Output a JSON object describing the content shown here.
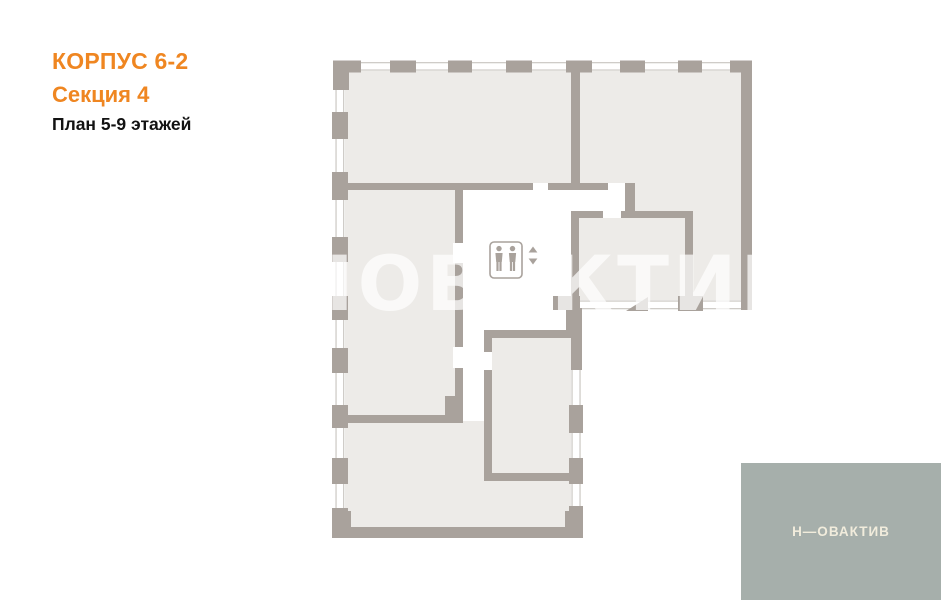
{
  "header": {
    "corpus": "КОРПУС 6-2",
    "section": "Секция 4",
    "floors_plan": "План 5-9 этажей"
  },
  "floor_plan": {
    "watermark": "НОВАКТИВ",
    "elevator_icon": "elevator-two-persons",
    "elevator_arrows": [
      "up",
      "down"
    ]
  },
  "branding": {
    "logo_text": "Н—ОВАКТИВ"
  },
  "colors": {
    "accent": "#ef8621",
    "wall": "#a9a29c",
    "room": "#edebe8",
    "window_line": "#cfccc8",
    "logo_bg": "#a6afab",
    "logo_text": "#f1ecdc"
  }
}
